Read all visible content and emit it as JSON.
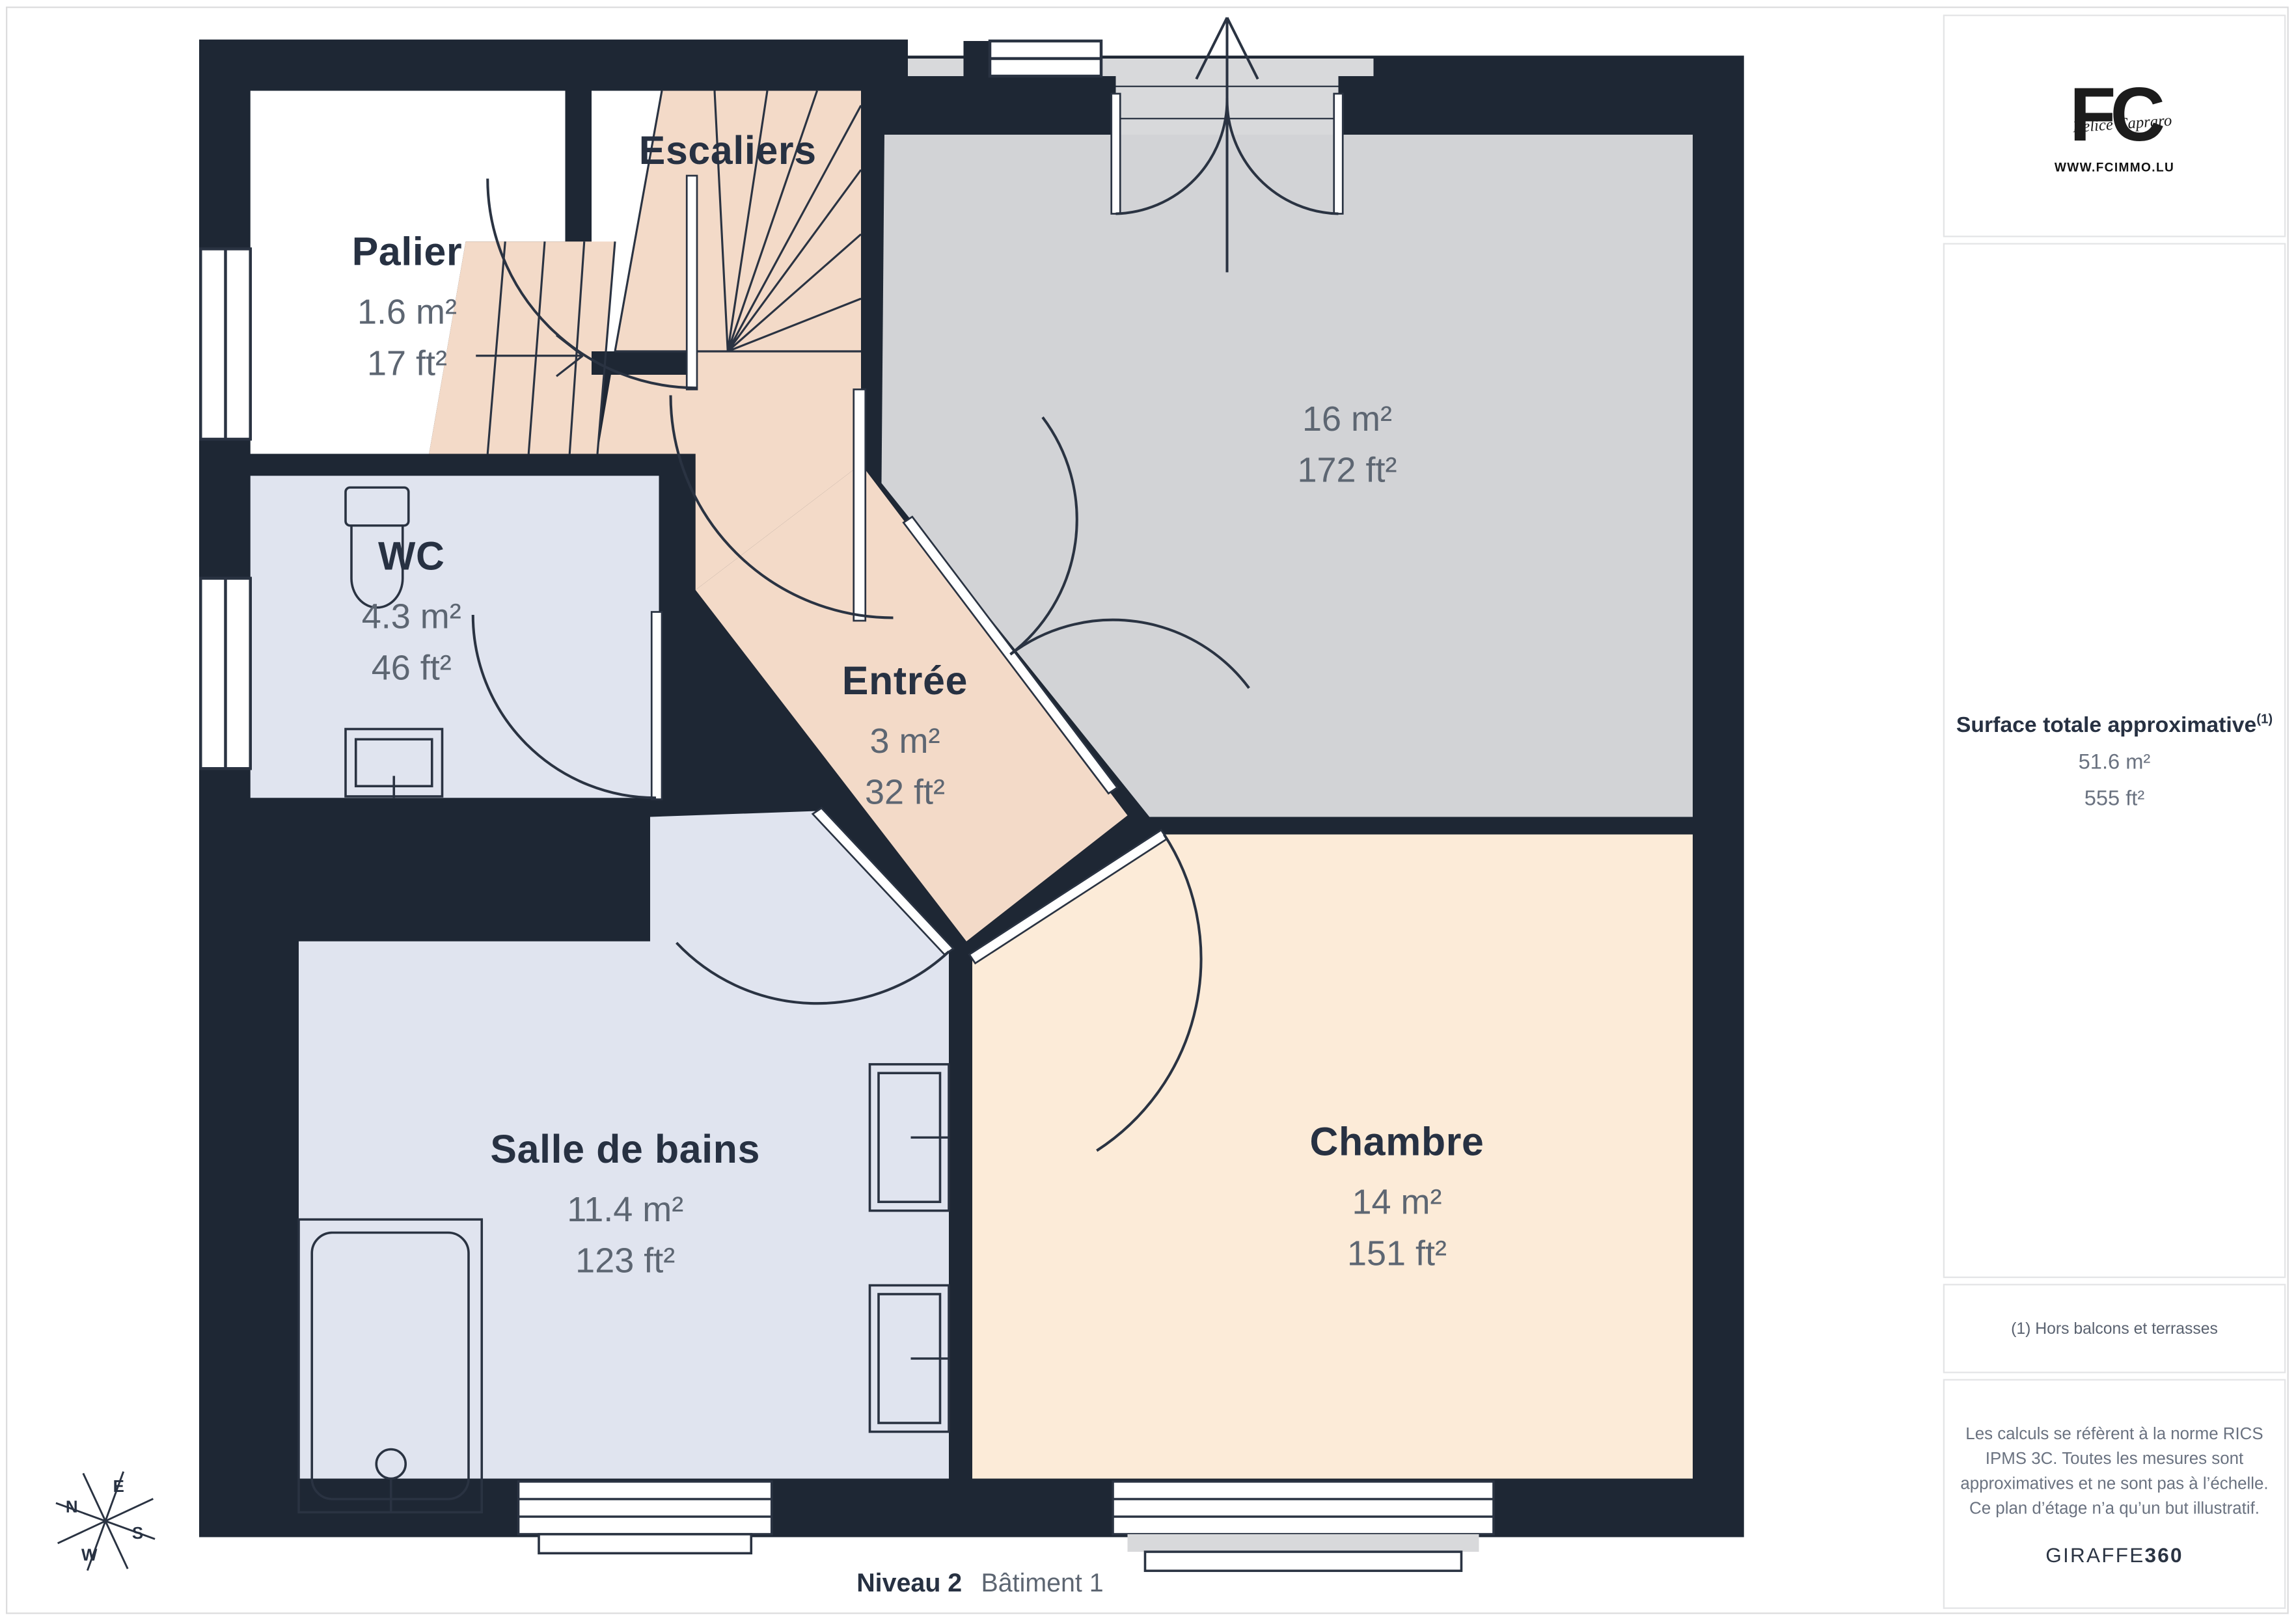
{
  "plan": {
    "rooms": [
      {
        "id": "palier",
        "name": "Palier",
        "area_m2": "1.6 m²",
        "area_ft2": "17 ft²"
      },
      {
        "id": "escaliers",
        "name": "Escaliers"
      },
      {
        "id": "wc",
        "name": "WC",
        "area_m2": "4.3 m²",
        "area_ft2": "46 ft²"
      },
      {
        "id": "entree",
        "name": "Entrée",
        "area_m2": "3 m²",
        "area_ft2": "32 ft²"
      },
      {
        "id": "sejour",
        "name": "",
        "area_m2": "16 m²",
        "area_ft2": "172 ft²"
      },
      {
        "id": "salle-de-bains",
        "name": "Salle de bains",
        "area_m2": "11.4 m²",
        "area_ft2": "123 ft²"
      },
      {
        "id": "chambre",
        "name": "Chambre",
        "area_m2": "14 m²",
        "area_ft2": "151 ft²"
      }
    ],
    "caption": {
      "level": "Niveau 2",
      "building": "Bâtiment 1"
    },
    "compass": {
      "n": "N",
      "e": "E",
      "s": "S",
      "w": "W"
    }
  },
  "sidebar": {
    "logo": {
      "monogram": "FC",
      "script": "Felice Capraro",
      "website": "WWW.FCIMMO.LU"
    },
    "surface": {
      "title": "Surface totale approximative",
      "footnote_ref": "(1)",
      "m2": "51.6 m²",
      "ft2": "555 ft²"
    },
    "footnote": "(1) Hors balcons et terrasses",
    "legal": "Les calculs se réfèrent à la norme RICS IPMS 3C. Toutes les mesures sont approximatives et ne sont pas à l’échelle. Ce plan d’étage n’a qu’un but illustratif.",
    "brand": {
      "name": "GIRAFFE",
      "suffix": "360"
    }
  },
  "colors": {
    "wall": "#1e2734",
    "line": "#2a3342",
    "room_white": "#ffffff",
    "room_peach": "#f3dac8",
    "room_cream": "#fcebd8",
    "room_blue": "#e0e4ef",
    "room_gray": "#d2d3d6",
    "balcony_gray": "#d8d9db",
    "ink": "#273142",
    "muted": "#5d6672",
    "border": "#e3e4e6"
  }
}
